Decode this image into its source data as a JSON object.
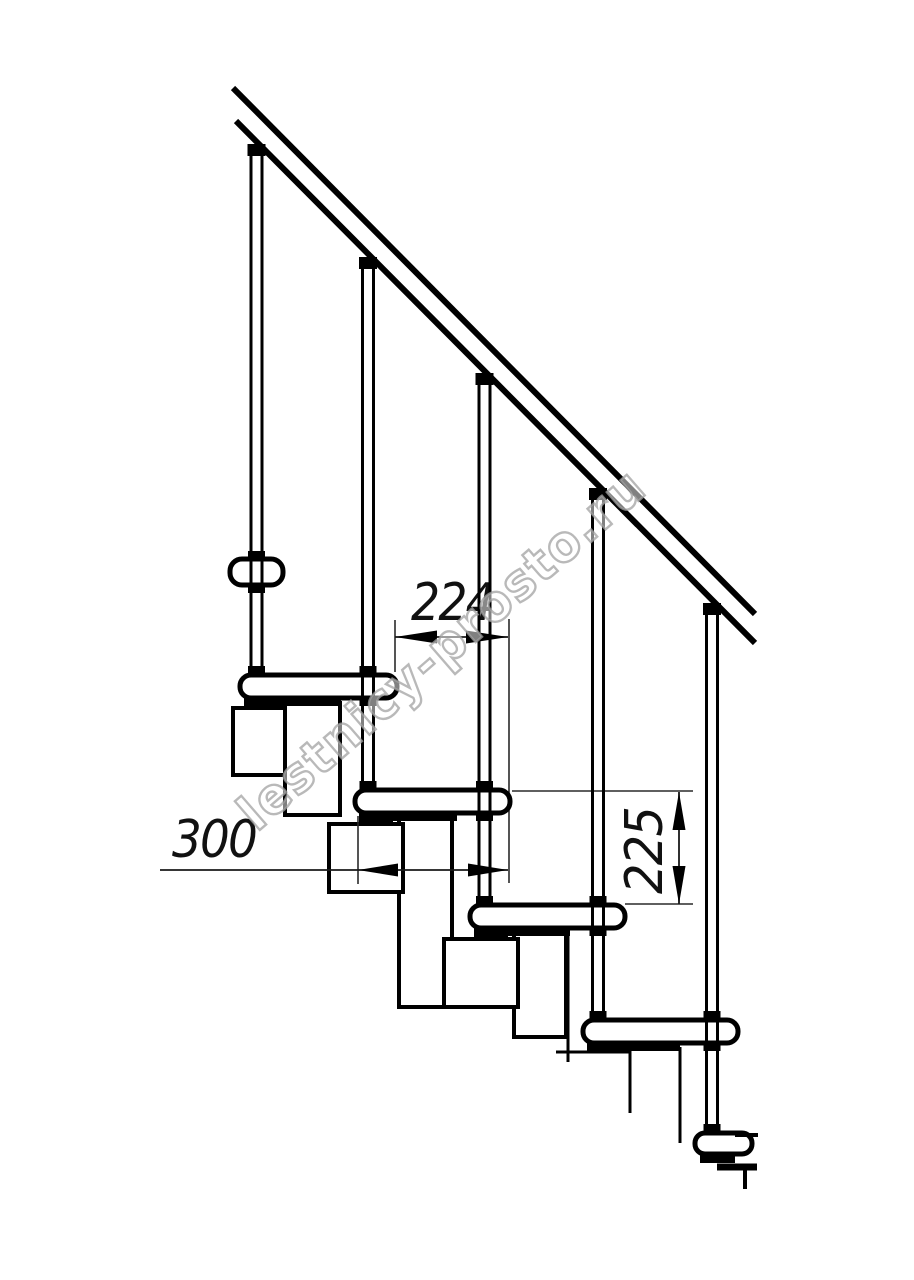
{
  "watermark": {
    "text": "lestnicy-prosto.ru",
    "stroke_color": "#a2a2a2"
  },
  "dimensions": {
    "step_spacing": "224",
    "tread_depth": "300",
    "riser_height": "225"
  },
  "colors": {
    "ink": "#000000",
    "thin_line": "#2a2a2a",
    "paper": "#ffffff"
  }
}
